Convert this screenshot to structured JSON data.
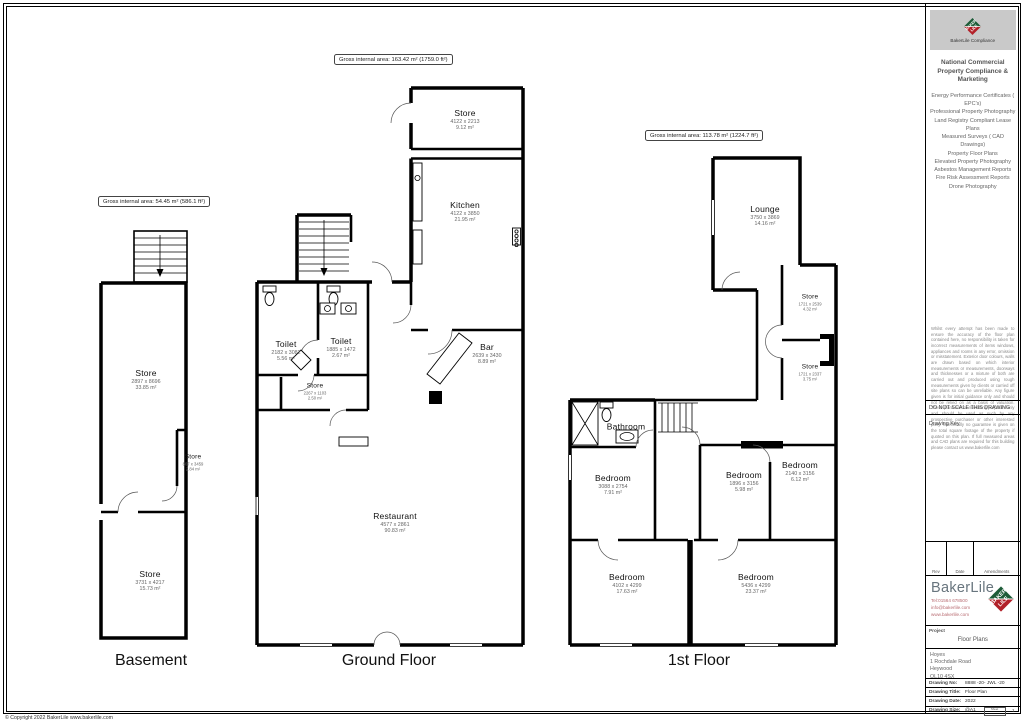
{
  "page": {
    "copyright": "© Copyright 2022 BakerLile   www.bakerlile.com"
  },
  "plans": {
    "basement": {
      "title": "Basement",
      "gia": "Gross internal area: 54.45 m² (586.1 ft²)",
      "rooms": [
        {
          "name": "Store",
          "dims": "2897 x 8696",
          "area": "33.85 m²"
        },
        {
          "name": "Store",
          "dims": "807 x 3459",
          "area": "2.84 m²"
        },
        {
          "name": "Store",
          "dims": "3731 x 4217",
          "area": "15.73 m²"
        }
      ]
    },
    "ground": {
      "title": "Ground Floor",
      "gia": "Gross internal area: 163.42 m² (1759.0 ft²)",
      "rooms": [
        {
          "name": "Store",
          "dims": "4122 x 2213",
          "area": "9.12 m²"
        },
        {
          "name": "Kitchen",
          "dims": "4122 x 3850",
          "area": "21.95 m²"
        },
        {
          "name": "Toilet",
          "dims": "2182 x 3082",
          "area": "5.56 m²"
        },
        {
          "name": "Toilet",
          "dims": "1885 x 1472",
          "area": "2.67 m²"
        },
        {
          "name": "Store",
          "dims": "2267 x 1103",
          "area": "2.50 m²"
        },
        {
          "name": "Bar",
          "dims": "2639 x 3430",
          "area": "8.89 m²"
        },
        {
          "name": "Restaurant",
          "dims": "4577 x 2861",
          "area": "90.83 m²"
        }
      ]
    },
    "first": {
      "title": "1st Floor",
      "gia": "Gross internal area: 113.78 m² (1224.7 ft²)",
      "rooms": [
        {
          "name": "Lounge",
          "dims": "3750 x 3869",
          "area": "14.16 m²"
        },
        {
          "name": "Store",
          "dims": "1721 x 2539",
          "area": "4.32 m²"
        },
        {
          "name": "Store",
          "dims": "1721 x 2337",
          "area": "3.75 m²"
        },
        {
          "name": "Bathroom",
          "dims": "",
          "area": ""
        },
        {
          "name": "Bedroom",
          "dims": "3088 x 2754",
          "area": "7.91 m²"
        },
        {
          "name": "Bedroom",
          "dims": "1896 x 3156",
          "area": "5.98 m²"
        },
        {
          "name": "Bedroom",
          "dims": "2140 x 3156",
          "area": "6.12 m²"
        },
        {
          "name": "Bedroom",
          "dims": "4102 x 4299",
          "area": "17.63 m²"
        },
        {
          "name": "Bedroom",
          "dims": "5436 x 4299",
          "area": "23.37 m²"
        }
      ]
    }
  },
  "sidebar": {
    "logo_caption": "BakerLile Compliance",
    "logo_text_top": "BAKER",
    "logo_text_bottom": "LILE",
    "heading": "National Commercial Property Compliance & Marketing",
    "services": [
      "Energy Performance Certificates ( EPC's)",
      "Professional Property Photography",
      "Land Registry Compliant Lease Plans",
      "Measured Surveys ( CAD Drawings)",
      "Property Floor Plans",
      "Elevated Property Photography",
      "Asbestos Management Reports Fire Risk Assessment Reports",
      "Drone Photography"
    ],
    "disclaimer": "Whilst every attempt has been made to ensure the accuracy of the floor plan contained here, no responsibility is taken for incorrect measurements of items windows, appliances and rooms in any error, omission or misstatement. Exterior door colours, walls are drawn based on which interior measurements or measurements, doorways and thicknesses or a mixture of both are carried out and produced using rough measurements given by clients or carried off site plans so can be unreliable. Any figure given is for initial guidance only and should not be relied on as a basis of valuation. These plans are for marketing purposes only and should be used as such by any prospective purchaser or other interested party. Specifically no guarantee is given on the total square footage of the property if quoted on this plan. If full measured areas and CAD plans are required for this building please contact us www.bakerlile.com",
    "do_not_scale": "DO NOT SCALE THIS DRAWING",
    "drawing_key": "Drawing Key",
    "rev_header": {
      "rev": "Rev",
      "date": "Date",
      "amendments": "Amendments"
    },
    "brand_name": "BakerLile",
    "contact": {
      "tel": "Tel:01564 678500",
      "email": "info@bakerlile.com",
      "web": "www.bakerlile.com"
    },
    "project_label": "Project",
    "project_value": "Floor Plans",
    "address": {
      "line1": "Hoyes",
      "line2": "1 Rochdale Road",
      "line3": "Heywood",
      "line4": "OL10 4SX"
    },
    "fields": [
      {
        "label": "Drawing No:",
        "value": "8888 -20- JWL -20"
      },
      {
        "label": "Drawing Title:",
        "value": "Floor Plan"
      },
      {
        "label": "Drawing Date:",
        "value": "2022"
      },
      {
        "label": "Drawing Size:",
        "value": "@A1"
      }
    ],
    "sheet_label": "Sheet",
    "sheet_value": "1"
  }
}
